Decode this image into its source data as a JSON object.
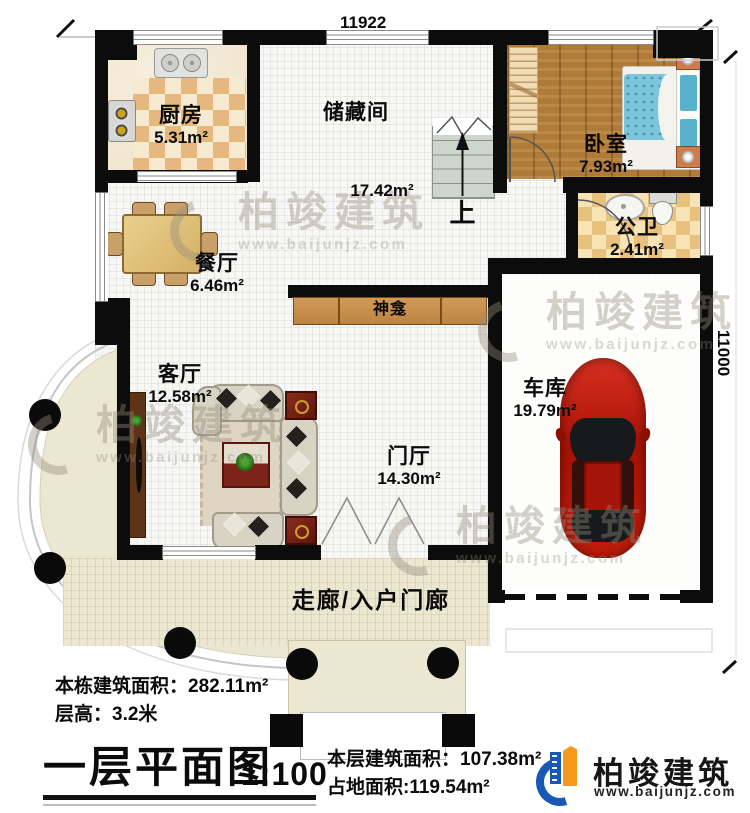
{
  "meta": {
    "drawing_title": "一层平面图",
    "scale": "1:100"
  },
  "dimensions": {
    "top_width": "11922",
    "right_height": "11000"
  },
  "rooms": [
    {
      "name": "厨房",
      "area": "5.31m²"
    },
    {
      "name": "储藏间",
      "area": "17.42m²"
    },
    {
      "name": "卧室",
      "area": "7.93m²"
    },
    {
      "name": "公卫",
      "area": "2.41m²"
    },
    {
      "name": "餐厅",
      "area": "6.46m²"
    },
    {
      "name": "神龛",
      "area": ""
    },
    {
      "name": "客厅",
      "area": "12.58m²"
    },
    {
      "name": "门厅",
      "area": "14.30m²"
    },
    {
      "name": "车库",
      "area": "19.79m²"
    },
    {
      "name": "走廊/入户门廊",
      "area": ""
    }
  ],
  "stairs": {
    "direction_label": "上"
  },
  "stats": {
    "building_total_label": "本栋建筑面积：",
    "building_total_value": "282.11m²",
    "floor_height_label": "层高：",
    "floor_height_value": "3.2米",
    "floor_area_label": "本层建筑面积：",
    "floor_area_value": "107.38m²",
    "footprint_label": "占地面积:",
    "footprint_value": "119.54m²"
  },
  "branding": {
    "company": "柏竣建筑",
    "website": "www.baijunjz.com"
  },
  "watermark": {
    "company": "柏竣建筑",
    "website": "www.baijunjz.com"
  },
  "colors": {
    "wall": "#0c0c0c",
    "brand_blue": "#1a58b8",
    "brand_orange": "#f59a1d",
    "car_red": "#c21d0c",
    "bed_blue": "#7cc6dc",
    "floor_cream": "#ece7d1",
    "cabinet_tan": "#c89252",
    "checker_tan": "#e6b87f"
  }
}
